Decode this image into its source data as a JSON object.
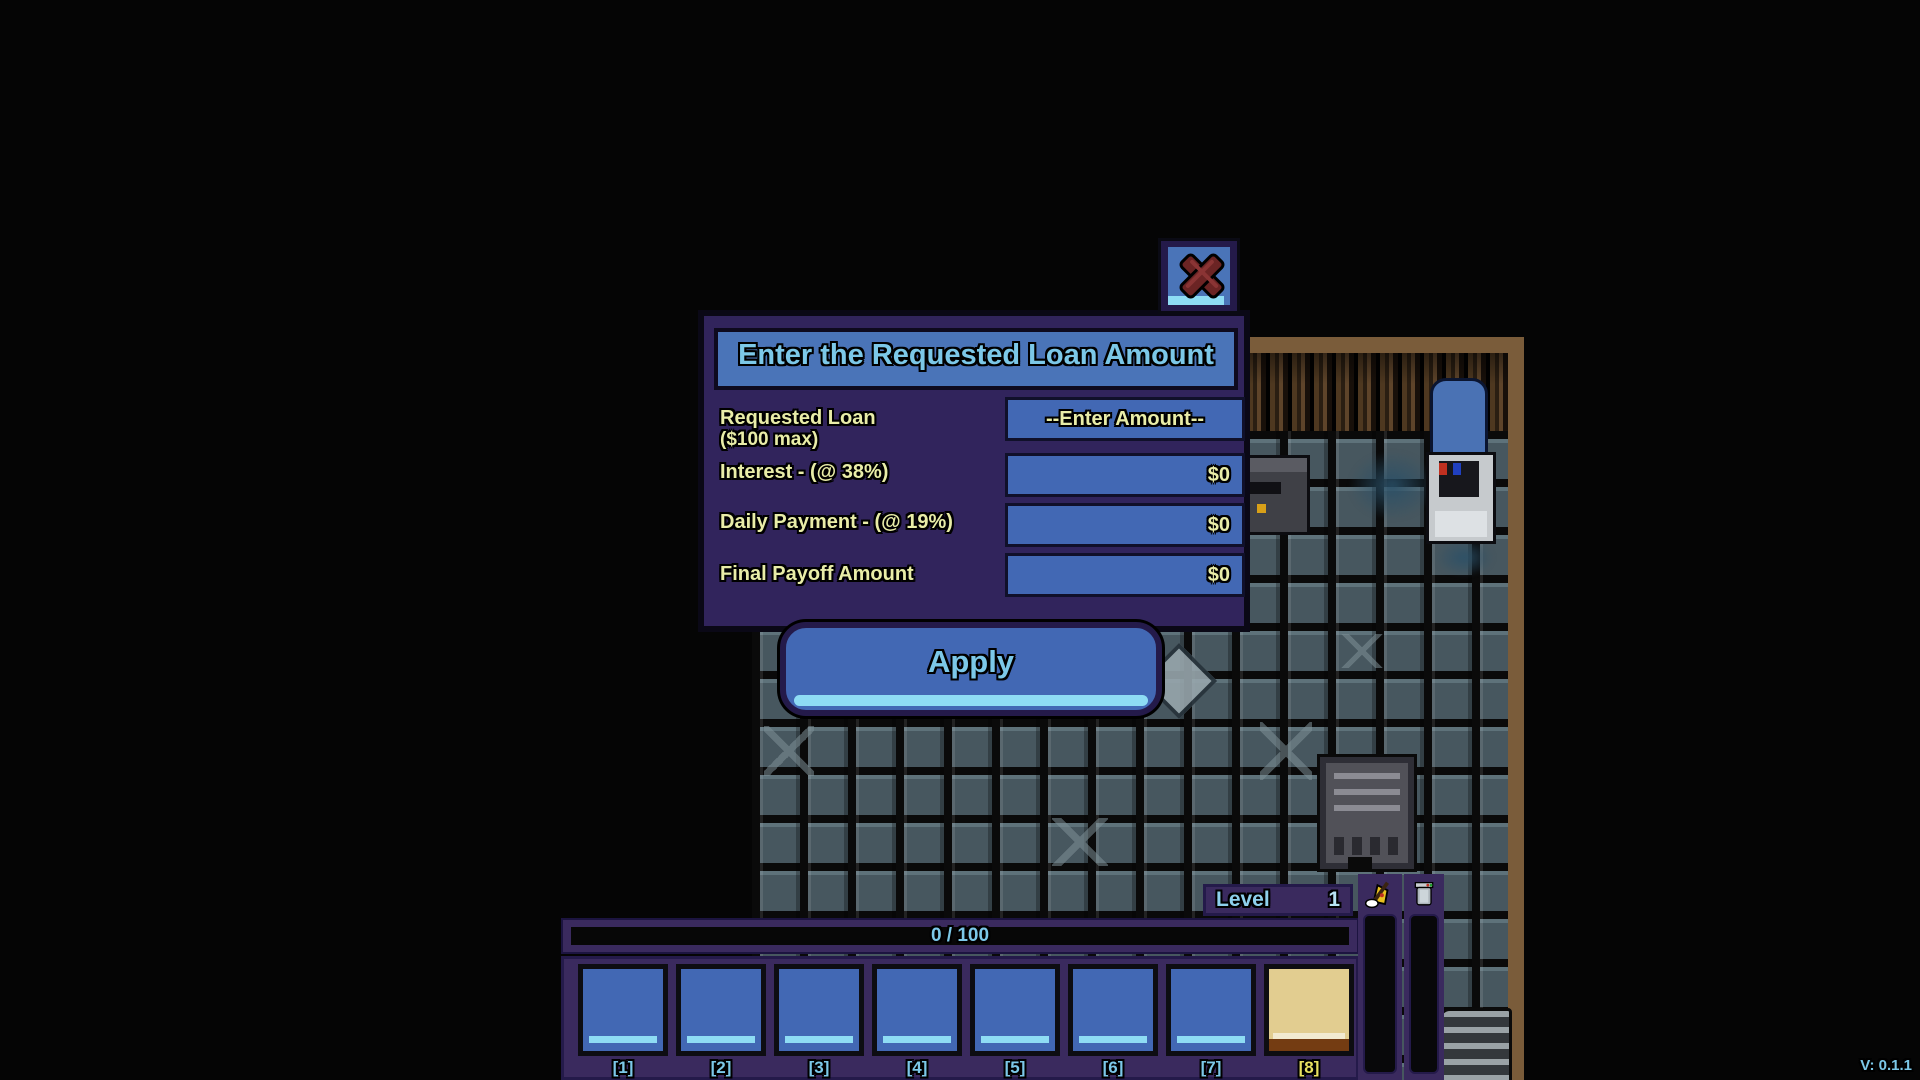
{
  "loan_dialog": {
    "title": "Enter the Requested Loan Amount",
    "close_icon": "x-icon",
    "rows": [
      {
        "label": "Requested Loan",
        "sublabel": "($100 max)",
        "value": "--Enter Amount--"
      },
      {
        "label": "Interest - (@ 38%)",
        "value": "$0"
      },
      {
        "label": "Daily Payment - (@ 19%)",
        "value": "$0"
      },
      {
        "label": "Final Payoff Amount",
        "value": "$0"
      }
    ],
    "apply_label": "Apply"
  },
  "hud": {
    "level": {
      "label": "Level",
      "value": "1"
    },
    "xp_bar": {
      "text": "0 / 100"
    },
    "hotbar": {
      "slots": [
        {
          "label": "[1]"
        },
        {
          "label": "[2]"
        },
        {
          "label": "[3]"
        },
        {
          "label": "[4]"
        },
        {
          "label": "[5]"
        },
        {
          "label": "[6]"
        },
        {
          "label": "[7]"
        },
        {
          "label": "[8]",
          "selected": true
        }
      ]
    },
    "meters": [
      {
        "icon": "mop-icon"
      },
      {
        "icon": "canister-icon"
      }
    ]
  },
  "version_label": "V: 0.1.1",
  "colors": {
    "accent_blue": "#4a74b8",
    "panel_purple": "#31245c",
    "hud_purple": "#3a2a5e",
    "text_cyan": "#7cc8e8",
    "text_yellow": "#e9eda8",
    "slot_blue": "#4268b4",
    "slot_selected_tan": "#e2cd90",
    "highlight_stripe": "#8edcf4",
    "close_x_red": "#6b2424",
    "wall_brown": "#7a5c3a",
    "tile_grey": "#47575f"
  }
}
